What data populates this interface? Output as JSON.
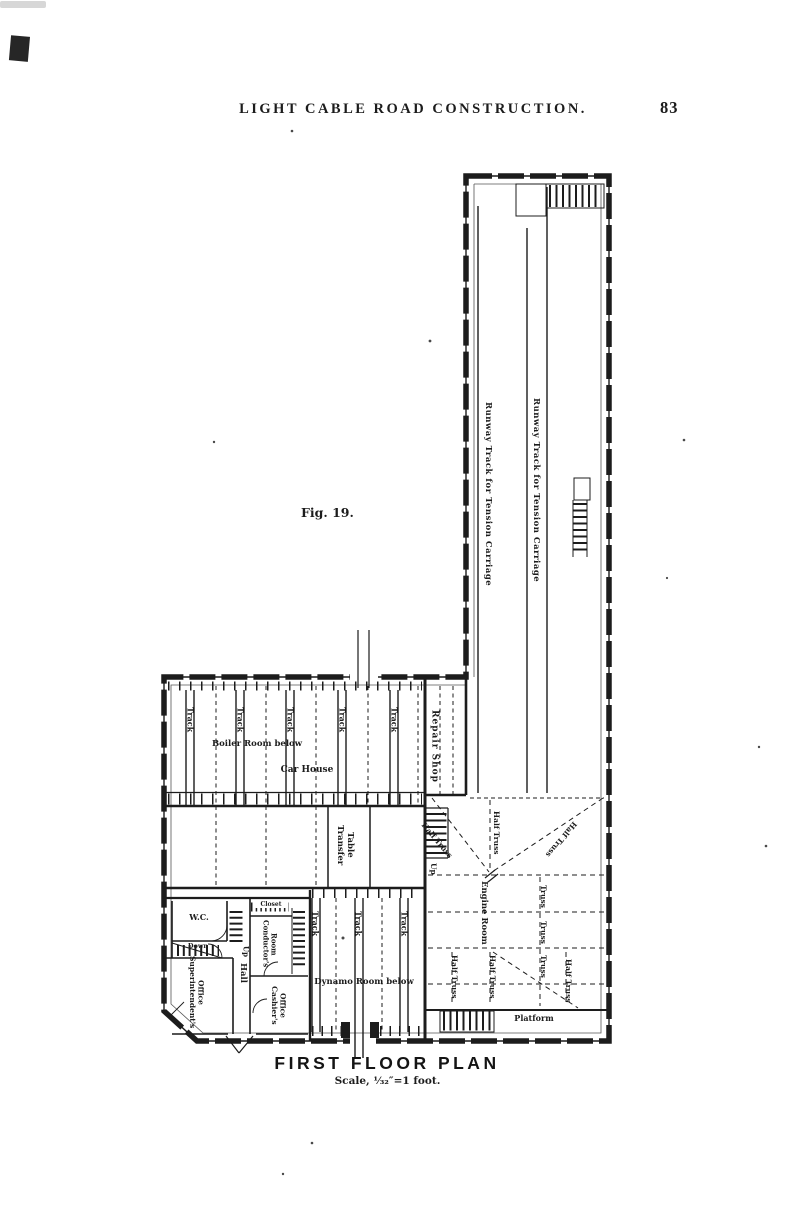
{
  "page": {
    "header": {
      "title": "LIGHT CABLE ROAD CONSTRUCTION.",
      "page_number": "83"
    },
    "figure_label": "Fig. 19.",
    "caption": {
      "title": "FIRST FLOOR PLAN",
      "scale": "Scale, ¹⁄₃₂″=1 foot."
    },
    "ink_color": "#1c1c1c",
    "paper_color": "#ffffff"
  },
  "plan": {
    "labels": {
      "runway_track": "Runway Track for Tension Carriage",
      "track": "Track",
      "repair_shop": "Repair Shop",
      "boiler_room": "Boiler Room below",
      "car_house": "Car House",
      "transfer_table": "Transfer Table",
      "engine_room": "Engine Room",
      "truss": "Truss",
      "half_truss": "Half Truss",
      "platform": "Platform",
      "dynamo_room": "Dynamo Room below",
      "wc": "W.C.",
      "down": "Down",
      "up": "Up",
      "superintendent_office": "Superintendent's Office",
      "hall": "Hall",
      "closet": "Closet",
      "conductor_room": "Conductor's Room",
      "cashier_office": "Cashier's Office"
    }
  }
}
